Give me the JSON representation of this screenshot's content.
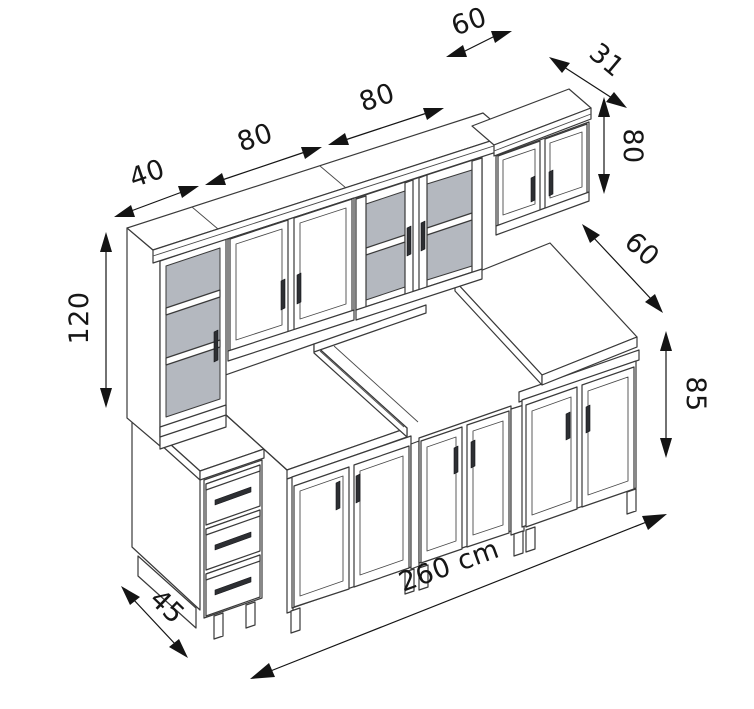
{
  "diagram": {
    "subject": "kitchen cabinet set — isometric dimension drawing",
    "unit": "cm",
    "dimensions": {
      "wall_unit_1_width": "40",
      "wall_unit_2_width": "80",
      "wall_unit_3_width": "80",
      "wall_unit_4_width": "60",
      "wall_unit_depth": "31",
      "wall_unit_height": "80",
      "tall_unit_height": "120",
      "worktop_depth": "60",
      "base_unit_height": "85",
      "left_unit_depth": "45",
      "total_length": "260 cm"
    }
  }
}
